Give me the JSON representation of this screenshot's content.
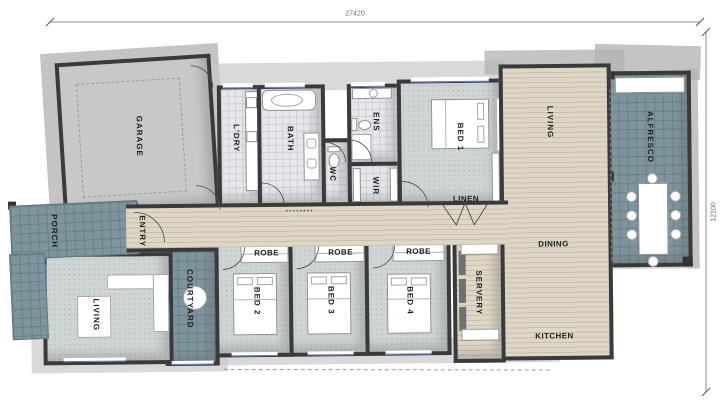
{
  "plan": {
    "dimensions": {
      "width_top": "27420",
      "height_right": "12100"
    },
    "rooms": {
      "garage": "GARAGE",
      "porch": "PORCH",
      "entry": "ENTRY",
      "courtyard": "COURTYARD",
      "living_front": "LIVING",
      "laundry": "L'DRY",
      "bath": "BATH",
      "wc": "WC",
      "ens": "ENS",
      "wir": "WIR",
      "bed1": "BED 1",
      "linen": "LINEN",
      "living_main": "LIVING",
      "alfresco": "ALFRESCO",
      "dining": "DINING",
      "servery": "SERVERY",
      "kitchen": "KITCHEN",
      "bed2": "BED 2",
      "bed3": "BED 3",
      "bed4": "BED 4",
      "robe_bed2": "ROBE",
      "robe_bed3": "ROBE",
      "robe_bed4": "ROBE"
    },
    "colors": {
      "wall": "#3a3a3c",
      "wood_floor": "#dbd2c1",
      "outdoor_tile": "#7f959d",
      "carpet": "#cfd4d5",
      "bath_tile": "#e6e7ea",
      "garage_floor": "#c8c8c8",
      "roof_shadow": "#b4b4b4",
      "window_glass": "#5b79c8"
    }
  }
}
